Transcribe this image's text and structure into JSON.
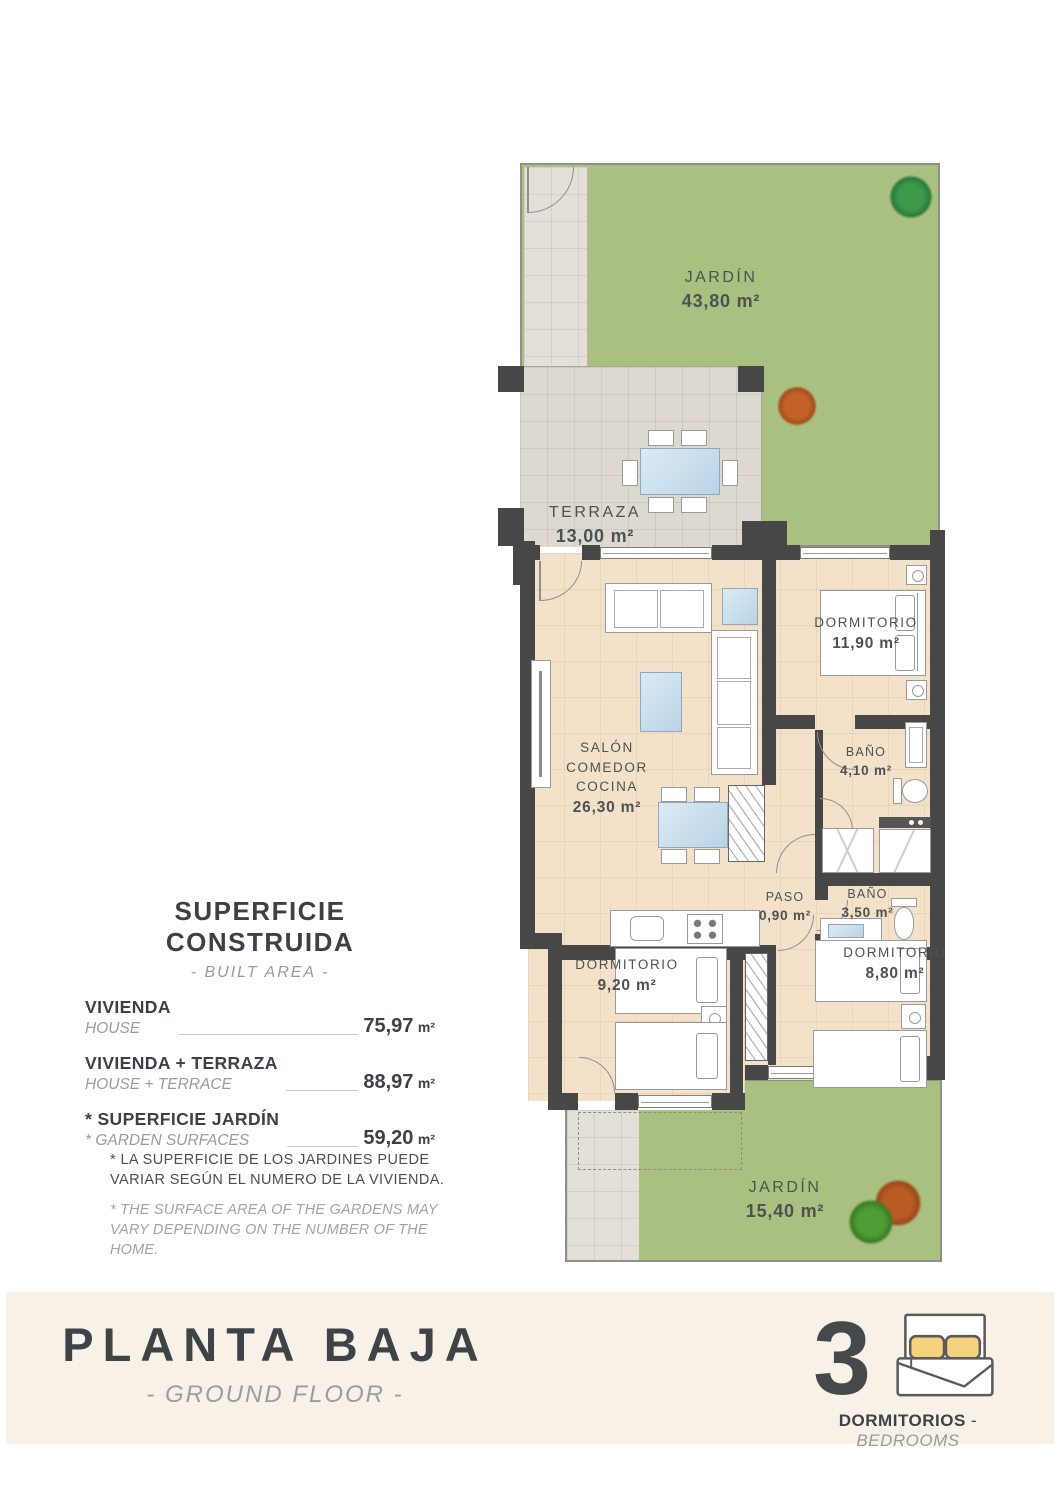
{
  "colors": {
    "wall": "#474747",
    "garden": "#a9c080",
    "floor": "#f3e1c9",
    "tile": "#ddd8d0",
    "path": "#e4dfd8",
    "cream": "#f8f1e7",
    "ink": "#3c4147",
    "muted": "#9b9b9b",
    "roomink": "#4b5350",
    "pillow": "#f5d27c"
  },
  "plan": {
    "jardin_top": {
      "name": "JARDÍN",
      "area": "43,80 m²"
    },
    "terraza": {
      "name": "TERRAZA",
      "area": "13,00 m²"
    },
    "salon": {
      "name": "SALÓN COMEDOR COCINA",
      "area": "26,30 m²"
    },
    "dormitorio_1": {
      "name": "DORMITORIO",
      "area": "11,90 m²"
    },
    "bano_1": {
      "name": "BAÑO",
      "area": "4,10 m²"
    },
    "paso": {
      "name": "PASO",
      "area": "0,90 m²"
    },
    "bano_2": {
      "name": "BAÑO",
      "area": "3,50 m²"
    },
    "dormitorio_2": {
      "name": "DORMITORIO",
      "area": "9,20 m²"
    },
    "dormitorio_3": {
      "name": "DORMITORIO",
      "area": "8,80 m²"
    },
    "jardin_bottom": {
      "name": "JARDÍN",
      "area": "15,40 m²"
    }
  },
  "areas_panel": {
    "title": "SUPERFICIE CONSTRUIDA",
    "subtitle": "- BUILT AREA -",
    "rows": [
      {
        "label_es": "VIVIENDA",
        "label_en": "HOUSE",
        "value": "75,97",
        "unit": "m²"
      },
      {
        "label_es": "VIVIENDA + TERRAZA",
        "label_en": "HOUSE + TERRACE",
        "value": "88,97",
        "unit": "m²"
      },
      {
        "label_es": "* SUPERFICIE JARDÍN",
        "label_en": "* GARDEN SURFACES",
        "value": "59,20",
        "unit": "m²"
      }
    ]
  },
  "disclaimer": {
    "es": "* LA SUPERFICIE DE LOS JARDINES PUEDE VARIAR SEGÚN EL NUMERO DE LA VIVIENDA.",
    "en": "* THE SURFACE AREA OF THE GARDENS MAY VARY DEPENDING ON THE NUMBER OF THE HOME."
  },
  "footer": {
    "title": "PLANTA BAJA",
    "subtitle": "- GROUND FLOOR -",
    "bedrooms_number": "3",
    "bedrooms_es": "DORMITORIOS",
    "bedrooms_sep": "-",
    "bedrooms_en": "BEDROOMS"
  }
}
